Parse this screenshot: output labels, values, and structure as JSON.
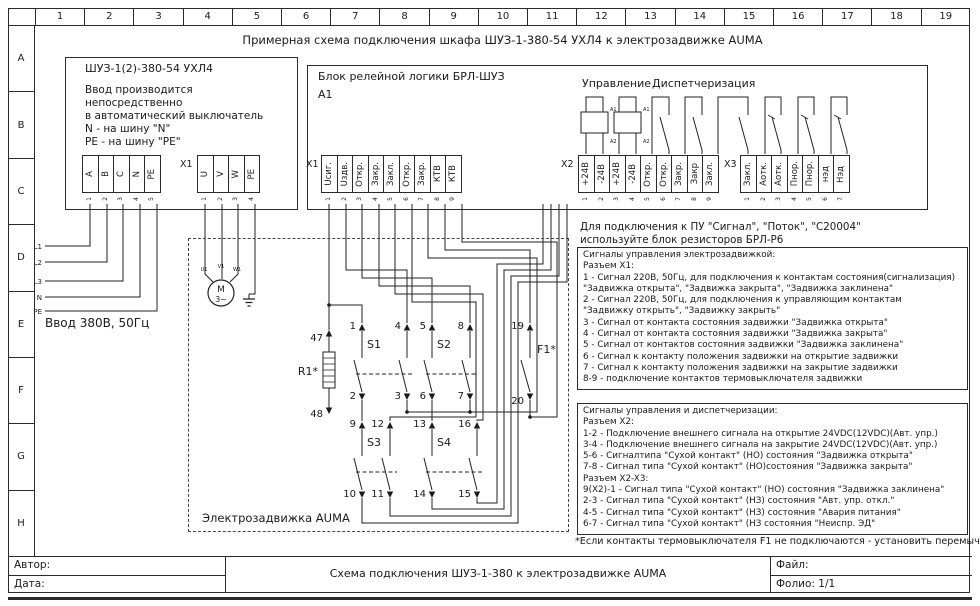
{
  "title": "Примерная схема подключения шкафа ШУЗ-1-380-54 УХЛ4 к электрозадвижке AUMA",
  "rulers": {
    "cols": [
      "1",
      "2",
      "3",
      "4",
      "5",
      "6",
      "7",
      "8",
      "9",
      "10",
      "11",
      "12",
      "13",
      "14",
      "15",
      "16",
      "17",
      "18",
      "19"
    ],
    "rows": [
      "A",
      "B",
      "C",
      "D",
      "E",
      "F",
      "G",
      "H"
    ]
  },
  "cabinet": {
    "title": "ШУЗ-1(2)-380-54 УХЛ4",
    "note1": "Ввод производится",
    "note2": "непосредственно",
    "note3": "в автоматический выключатель",
    "note4": "N - на шину \"N\"",
    "note5": "PE - на шину \"PE\"",
    "input_caption": "Ввод 380В, 50Гц",
    "feeds": [
      "L1",
      "L2",
      "L3",
      "N",
      "PE"
    ]
  },
  "strip_input": {
    "labels": [
      "А",
      "В",
      "С",
      "N",
      "PE"
    ],
    "pins": [
      "1",
      "2",
      "3",
      "4",
      "5"
    ]
  },
  "strip_x1m": {
    "name": "X1",
    "labels": [
      "U",
      "V",
      "W",
      "PE"
    ],
    "pins": [
      "1",
      "2",
      "3",
      "4"
    ]
  },
  "brl": {
    "title": "Блок релейной логики БРЛ-ШУЗ",
    "ref": "А1",
    "x1_name": "X1",
    "x2_name": "X2",
    "x3_name": "X3",
    "control": "Управление",
    "dispatch": "Диспетчеризация",
    "coil_a1": "A1",
    "coil_a2": "A2",
    "x1": {
      "labels": [
        "Uсиг.",
        "Uздв.",
        "Откр.",
        "Закр.",
        "Закл.",
        "Откр.",
        "Закр.",
        "КТВ",
        "КТВ"
      ],
      "pins": [
        "1",
        "2",
        "3",
        "4",
        "5",
        "6",
        "7",
        "8",
        "9"
      ]
    },
    "x2": {
      "labels": [
        "+24В",
        "-24В",
        "+24В",
        "-24В",
        "Откр.",
        "Откр.",
        "Закр.",
        "Закр",
        "Закл."
      ],
      "pins": [
        "1",
        "2",
        "3",
        "4",
        "5",
        "6",
        "7",
        "8",
        "9"
      ]
    },
    "x3": {
      "labels": [
        "Закл.",
        "Аотк.",
        "Аотк.",
        "Пнор.",
        "Пнор.",
        "нэд",
        "Нэд"
      ],
      "pins": [
        "1",
        "2",
        "3",
        "4",
        "5",
        "6",
        "7"
      ]
    }
  },
  "actuator": {
    "caption": "Электрозадвижка AUMA",
    "motor": "M",
    "motor_sub": "3~",
    "mterm": [
      "U1",
      "V1",
      "W1"
    ],
    "r1": "R1*",
    "f1": "F1*",
    "s1": "S1",
    "s2": "S2",
    "s3": "S3",
    "s4": "S4",
    "n1": "1",
    "n2": "2",
    "n3": "3",
    "n4": "4",
    "n5": "5",
    "n6": "6",
    "n7": "7",
    "n8": "8",
    "n9": "9",
    "n10": "10",
    "n11": "11",
    "n12": "12",
    "n13": "13",
    "n14": "14",
    "n15": "15",
    "n16": "16",
    "n19": "19",
    "n20": "20",
    "n47": "47",
    "n48": "48"
  },
  "notes": {
    "pu1": "Для подключения к ПУ \"Сигнал\", \"Поток\", \"С20004\"",
    "pu2": "используйте блок резисторов БРЛ-Р6",
    "box1": [
      "Сигналы управления электрозадвижкой:",
      "Разъем X1:",
      "1 - Сигнал 220В, 50Гц, для подключения к контактам состояния(сигнализация)",
      "\"Задвижка открыта\", \"Задвижка закрыта\", \"Задвижка заклинена\"",
      "2 - Сигнал 220В, 50Гц, для подключения к управляющим контактам",
      "\"Задвижку открыть\", \"Задвижку закрыть\"",
      "3 - Сигнал от контакта состояния задвижки \"Задвижка открыта\"",
      "4 - Сигнал от контакта состояния задвижки \"Задвижка закрыта\"",
      "5 - Сигнал от контактов состояния задвижки \"Задвижка заклинена\"",
      "6 - Сигнал к контакту положения задвижки на открытие задвижки",
      "7 - Сигнал к контакту положения задвижки на закрытие задвижки",
      "8-9 - подключение контактов термовыключателя задвижки"
    ],
    "box2": [
      "Сигналы управления и диспетчеризации:",
      "Разъем X2:",
      "1-2 - Подключение внешнего сигнала на открытие 24VDC(12VDC)(Авт. упр.)",
      "3-4 - Подключение внешнего сигнала на закрытие 24VDC(12VDC)(Авт. упр.)",
      "5-6 - Сигналтипа \"Сухой контакт\" (НО) состояния \"Задвижка открыта\"",
      "7-8 - Сигнал типа \"Сухой контакт\" (НО)состояния \"Задвижка закрыта\"",
      "Разъем X2-X3:",
      "9(X2)-1 - Сигнал типа \"Сухой контакт\" (НО) состояния \"Задвижка заклинена\"",
      "2-3 - Сигнал типа \"Сухой контакт\" (НЗ) состояния \"Авт. упр. откл.\"",
      "4-5 - Сигнал типа \"Сухой контакт\" (НЗ) состояния \"Авария питания\"",
      "6-7 - Сигнал типа \"Сухой контакт\" (НЗ состояния \"Неиспр. ЭД\""
    ],
    "footnote": "*Если контакты термовыключателя F1 не подключаются - установить перемычку!"
  },
  "titleblock": {
    "author": "Автор:",
    "date": "Дата:",
    "center": "Схема подключения ШУЗ-1-380 к электрозадвижке AUMA",
    "file": "Файл:",
    "folio": "Фолио: 1/1"
  }
}
